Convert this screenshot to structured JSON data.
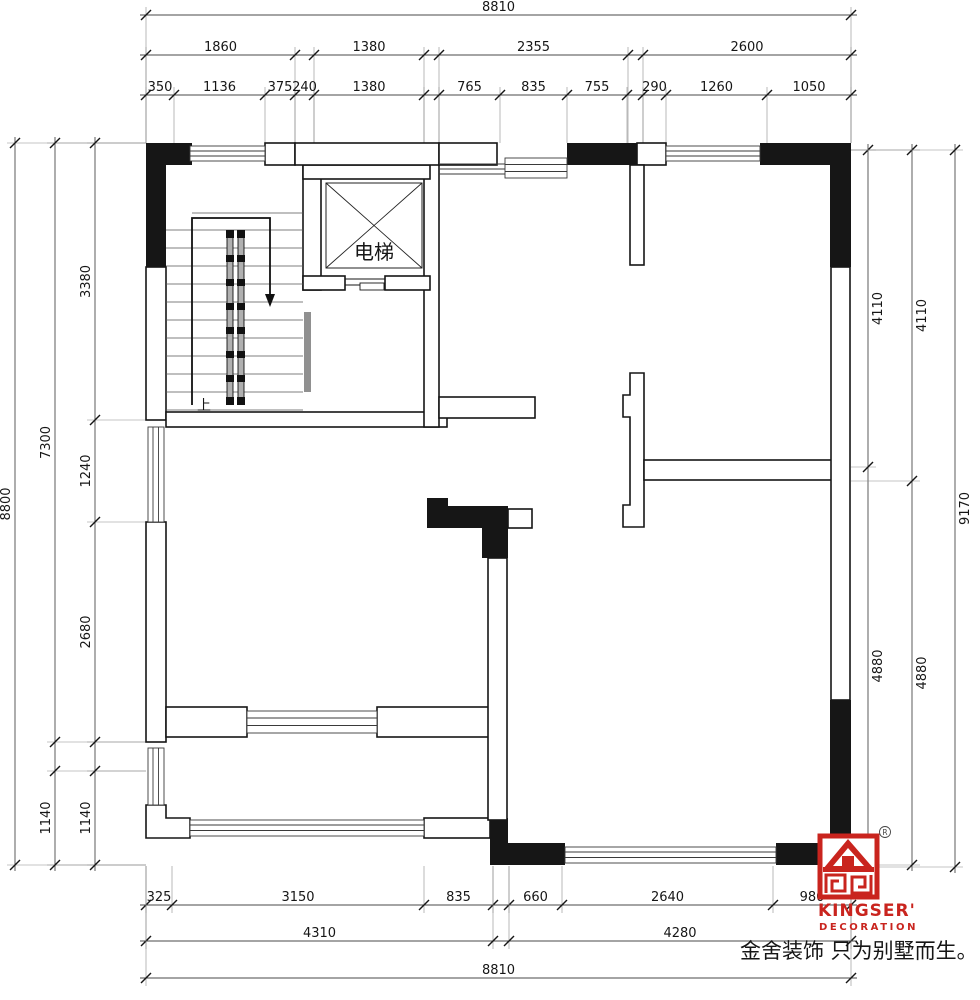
{
  "plan": {
    "elevator_label": "电梯",
    "up_label": "上",
    "slogan": "金舍装饰 只为别墅而生。"
  },
  "brand": {
    "name": "KINGSER'",
    "subtitle": "DECORATION",
    "registered": "R"
  },
  "colors": {
    "line": "#161616",
    "wall_fill": "#161616",
    "brand_red": "#C9241E",
    "window_line": "#3a3a3a",
    "rail_gray": "#b0b0b0"
  },
  "dimensions": [
    {
      "orient": "h",
      "pos": 15,
      "reach": 143,
      "segments": [
        {
          "label": "8810",
          "from": 146,
          "to": 851
        }
      ]
    },
    {
      "orient": "h",
      "pos": 55,
      "reach": 143,
      "segments": [
        {
          "label": "1860",
          "from": 146,
          "to": 295
        },
        {
          "label": "1380",
          "from": 314,
          "to": 424
        },
        {
          "label": "2355",
          "from": 439,
          "to": 628
        },
        {
          "label": "2600",
          "from": 643,
          "to": 851
        }
      ]
    },
    {
      "orient": "h",
      "pos": 95,
      "reach": 143,
      "segments": [
        {
          "label": "350",
          "from": 146,
          "to": 174
        },
        {
          "label": "1136",
          "from": 174,
          "to": 265
        },
        {
          "label": "375",
          "from": 265,
          "to": 295
        },
        {
          "label": "240",
          "from": 295,
          "to": 314
        },
        {
          "label": "1380",
          "from": 314,
          "to": 424
        },
        {
          "label": "765",
          "from": 439,
          "to": 500
        },
        {
          "label": "835",
          "from": 500,
          "to": 567
        },
        {
          "label": "755",
          "from": 567,
          "to": 627
        },
        {
          "label": "290",
          "from": 643,
          "to": 666
        },
        {
          "label": "1260",
          "from": 666,
          "to": 767
        },
        {
          "label": "1050",
          "from": 767,
          "to": 851
        }
      ]
    },
    {
      "orient": "v",
      "pos": 15,
      "side": "left",
      "reach": 146,
      "segments": [
        {
          "label": "8800",
          "from": 143,
          "to": 865
        }
      ]
    },
    {
      "orient": "v",
      "pos": 55,
      "side": "left",
      "reach": 146,
      "segments": [
        {
          "label": "7300",
          "from": 143,
          "to": 742
        },
        {
          "label": "1140",
          "from": 771,
          "to": 865
        }
      ]
    },
    {
      "orient": "v",
      "pos": 95,
      "side": "left",
      "reach": 146,
      "segments": [
        {
          "label": "3380",
          "from": 143,
          "to": 420
        },
        {
          "label": "1240",
          "from": 420,
          "to": 522
        },
        {
          "label": "2680",
          "from": 522,
          "to": 742
        },
        {
          "label": "1140",
          "from": 771,
          "to": 865
        }
      ]
    },
    {
      "orient": "v",
      "pos": 868,
      "side": "right",
      "reach": 851,
      "segments": [
        {
          "label": "4110",
          "from": 150,
          "to": 467
        },
        {
          "label": "4880",
          "from": 467,
          "to": 865
        }
      ]
    },
    {
      "orient": "v",
      "pos": 912,
      "side": "right",
      "reach": 851,
      "segments": [
        {
          "label": "4110",
          "from": 150,
          "to": 481
        },
        {
          "label": "4880",
          "from": 481,
          "to": 865
        }
      ]
    },
    {
      "orient": "v",
      "pos": 955,
      "side": "right",
      "reach": 851,
      "segments": [
        {
          "label": "9170",
          "from": 150,
          "to": 867
        }
      ]
    },
    {
      "orient": "h",
      "pos": 905,
      "reach": 866,
      "segments": [
        {
          "label": "325",
          "from": 146,
          "to": 172
        },
        {
          "label": "3150",
          "from": 172,
          "to": 424
        },
        {
          "label": "835",
          "from": 424,
          "to": 493
        },
        {
          "label": "660",
          "from": 509,
          "to": 562
        },
        {
          "label": "2640",
          "from": 562,
          "to": 773
        },
        {
          "label": "980",
          "from": 773,
          "to": 851
        }
      ]
    },
    {
      "orient": "h",
      "pos": 941,
      "reach": 866,
      "segments": [
        {
          "label": "4310",
          "from": 146,
          "to": 493
        },
        {
          "label": "4280",
          "from": 509,
          "to": 851
        }
      ]
    },
    {
      "orient": "h",
      "pos": 978,
      "reach": 866,
      "segments": [
        {
          "label": "8810",
          "from": 146,
          "to": 851
        }
      ]
    }
  ]
}
